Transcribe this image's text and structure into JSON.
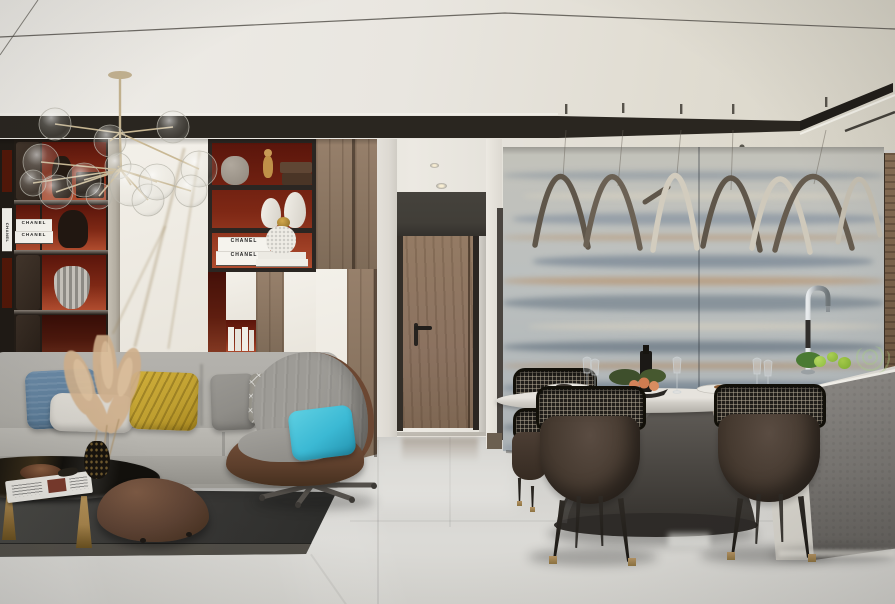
{
  "texts": {
    "chanel": "CHANEL"
  },
  "palette": {
    "ceiling": "#eae7e0",
    "ceiling_warm": "#d9d5c8",
    "band": "#29251f",
    "hall_wall": "#ece9e2",
    "jamb": "#ddd9d2",
    "marble": "#f3f0e9",
    "vein": "#b9a888",
    "pilaster": "#b5afa3",
    "wood": "#8f7a65",
    "door": "#8b7260",
    "door_header": "#413e38",
    "red_deep": "#5a150b",
    "red_lit": "#b04c2e",
    "frame": "#2b2622",
    "book": "#f5f3ed",
    "feature_base": "#bcc0bf",
    "feature_blue": "#5f7289",
    "feature_rust": "#b5773b",
    "feature_cream": "#ded6c1",
    "ribbon_dark": "#5f564a",
    "ribbon_light": "#cfc9bb",
    "floor": "#d5d3cf",
    "rug": "#3a3937",
    "rug_edge": "#56534c",
    "sofa": "#aeaca6",
    "sofa_deep": "#908e88",
    "pillow_blue": "#5e7e9a",
    "pillow_yellow": "#bf9f30",
    "pillow_gray": "#8f8d88",
    "pillow_white": "#d6d3cc",
    "pillow_plaid": "#9b988f",
    "pillow_teal": "#3bb9d4",
    "pampas": "#cbac8a",
    "ottoman": "#5d4233",
    "glass_table": "#12100c",
    "gold": "#a8854c",
    "chair_gray": "#96948f",
    "chair_trim": "#6b4732",
    "dine_chair": "#463a30",
    "cane": "#211e1a",
    "brass": "#b39263",
    "table_top": "#dcd9d2",
    "pedestal": "#4a4741",
    "island_marble": "#edebe4",
    "island_stone": "#7b7874",
    "chrome": "#aab0b3",
    "produce": "#8fbf3f",
    "cabbage": "#41682f",
    "peach": "#d4845a"
  },
  "scene": {
    "type": "photorealistic interior render",
    "areas": [
      "living room with gray sectional sofa",
      "hallway with wooden door",
      "dining area with marble feature wall",
      "kitchen island"
    ],
    "objects": [
      "brass sputnik chandelier with clear glass globes",
      "red back-lit display shelving with CHANEL books and vases",
      "white marble wall panels with veining",
      "gray fabric sofa with blue, white, yellow, gray and plaid pillows",
      "pampas grass in dark glass vase on black glass coffee table with gold legs",
      "brown leather ottoman on dark charcoal rug",
      "gray wingback swivel chair with brown leather shell and teal pillow",
      "wooden interior door with black header panel",
      "blue-rust streaked marble feature wall",
      "bronze ribbon pendant sculpture on cables",
      "oval marble dining table with sculptural gray pedestal",
      "dark brown dining chairs with woven cane backrests and brass leg tips",
      "kitchen island with white marble waterfall top, gray stone front, chrome faucet and green produce",
      "polished light gray marble floor"
    ]
  }
}
